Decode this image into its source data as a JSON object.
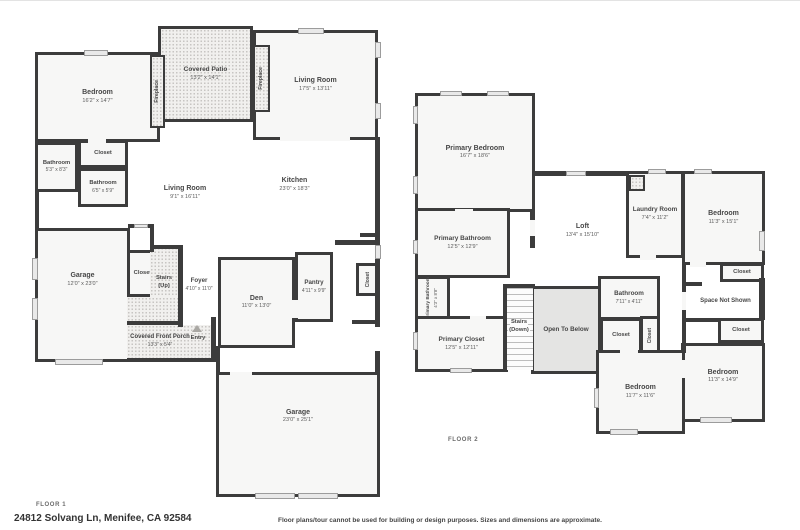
{
  "meta": {
    "floor1_label": "FLOOR 1",
    "floor2_label": "FLOOR 2",
    "address": "24812 Solvang Ln, Menifee, CA 92584",
    "disclaimer": "Floor plans/tour cannot be used for building or design purposes. Sizes and dimensions are approximate."
  },
  "colors": {
    "wall": "#3c3c3c",
    "room_fill": "#f7f7f6",
    "hatch_dot": "#c7c5c2",
    "open_to_below_fill": "#e4e4e3",
    "window_fill": "#e9e9e9",
    "label_text": "#474747"
  },
  "floor1": {
    "rooms": {
      "bedroom": {
        "name": "Bedroom",
        "dims": "16'2\" x 14'7\""
      },
      "covered_patio": {
        "name": "Covered Patio",
        "dims": "13'2\" x 14'1\""
      },
      "fireplace_left": {
        "name": "Fireplace"
      },
      "fireplace_right": {
        "name": "Fireplace"
      },
      "living_room_front": {
        "name": "Living Room",
        "dims": "17'5\" x 13'11\""
      },
      "closet_hall": {
        "name": "Closet"
      },
      "bathroom_1": {
        "name": "Bathroom",
        "dims": "5'3\" x 8'3\""
      },
      "bathroom_2": {
        "name": "Bathroom",
        "dims": "6'5\" x 5'9\""
      },
      "living_room_center": {
        "name": "Living Room",
        "dims": "9'1\" x 16'11\""
      },
      "kitchen": {
        "name": "Kitchen",
        "dims": "23'0\" x 18'3\""
      },
      "garage_side": {
        "name": "Garage",
        "dims": "12'0\" x 23'0\""
      },
      "closet_stairs": {
        "name": "Closet"
      },
      "stairs_up": {
        "name": "Stairs",
        "sub": "(Up)"
      },
      "foyer": {
        "name": "Foyer",
        "dims": "4'10\" x 11'0\""
      },
      "den": {
        "name": "Den",
        "dims": "11'0\" x 13'0\""
      },
      "pantry": {
        "name": "Pantry",
        "dims": "4'11\" x 9'9\""
      },
      "closet_kitchen": {
        "name": "Closet"
      },
      "covered_front_porch": {
        "name": "Covered Front Porch",
        "dims": "13'3\" x 5'4\""
      },
      "entry": {
        "name": "Entry"
      },
      "garage_rear": {
        "name": "Garage",
        "dims": "23'0\" x 25'1\""
      }
    }
  },
  "floor2": {
    "rooms": {
      "primary_bedroom": {
        "name": "Primary Bedroom",
        "dims": "16'7\" x 18'6\""
      },
      "primary_bathroom": {
        "name": "Primary Bathroom",
        "dims": "12'5\" x 12'9\""
      },
      "primary_bathroom_2": {
        "name": "Primary Bathroom",
        "dims": "4'3\" x 8'8\""
      },
      "primary_closet": {
        "name": "Primary Closet",
        "dims": "12'5\" x 12'11\""
      },
      "loft": {
        "name": "Loft",
        "dims": "13'4\" x 15'10\""
      },
      "laundry_room": {
        "name": "Laundry Room",
        "dims": "7'4\" x 11'2\""
      },
      "bedroom_ne": {
        "name": "Bedroom",
        "dims": "11'3\" x 15'1\""
      },
      "closet_ne": {
        "name": "Closet"
      },
      "space_not_shown": {
        "name": "Space Not Shown"
      },
      "closet_se": {
        "name": "Closet"
      },
      "bedroom_se": {
        "name": "Bedroom",
        "dims": "11'3\" x 14'9\""
      },
      "stairs_down": {
        "name": "Stairs",
        "sub": "(Down)"
      },
      "open_to_below": {
        "name": "Open To Below"
      },
      "bathroom": {
        "name": "Bathroom",
        "dims": "7'11\" x 4'11\""
      },
      "closet_hall_a": {
        "name": "Closet"
      },
      "closet_hall_b": {
        "name": "Closet"
      },
      "bedroom_s": {
        "name": "Bedroom",
        "dims": "11'7\" x 11'6\""
      }
    }
  }
}
